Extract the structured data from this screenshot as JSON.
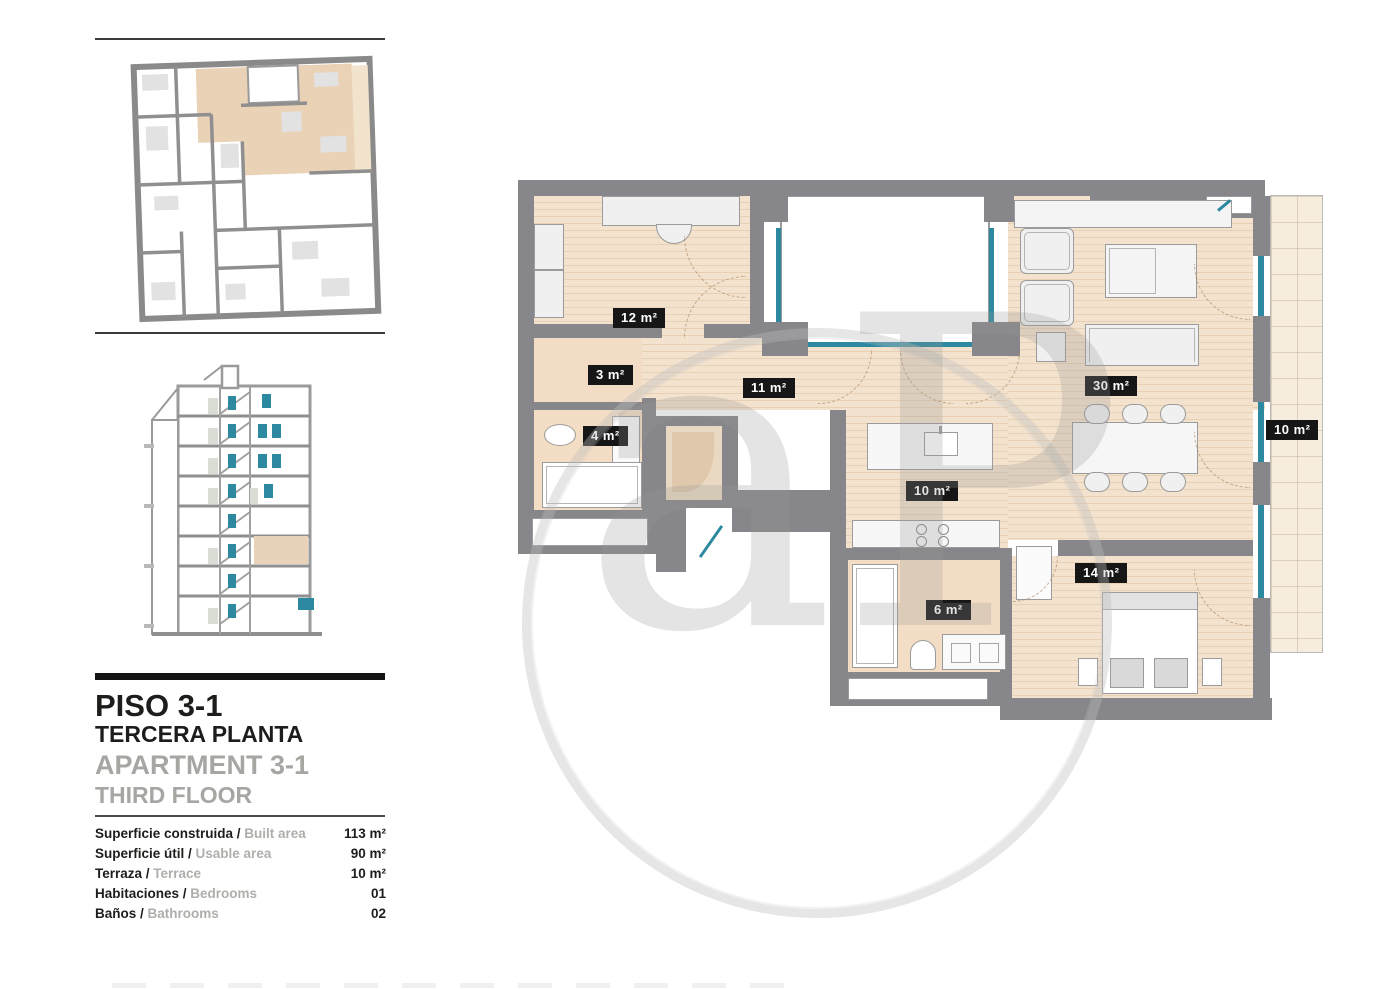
{
  "sidebar": {
    "title_line1": "PISO 3-1",
    "title_line2": "TERCERA PLANTA",
    "subtitle_line1": "APARTMENT 3-1",
    "subtitle_line2": "THIRD FLOOR",
    "separator": " / ",
    "info_rows": [
      {
        "label_es": "Superficie construida",
        "label_en": "Built area",
        "value": "113 m²"
      },
      {
        "label_es": "Superficie útil",
        "label_en": "Usable area",
        "value": "90 m²"
      },
      {
        "label_es": "Terraza",
        "label_en": "Terrace",
        "value": "10 m²"
      },
      {
        "label_es": "Habitaciones",
        "label_en": "Bedrooms",
        "value": "01"
      },
      {
        "label_es": "Baños",
        "label_en": "Bathrooms",
        "value": "02"
      }
    ]
  },
  "floorplan": {
    "room_labels": [
      {
        "name": "bedroom-study",
        "text": "12 m²",
        "x": 95,
        "y": 128
      },
      {
        "name": "hall",
        "text": "3 m²",
        "x": 70,
        "y": 185
      },
      {
        "name": "corridor",
        "text": "11 m²",
        "x": 225,
        "y": 198
      },
      {
        "name": "bathroom-1",
        "text": "4 m²",
        "x": 65,
        "y": 246
      },
      {
        "name": "kitchen",
        "text": "10 m²",
        "x": 388,
        "y": 301
      },
      {
        "name": "living-room",
        "text": "30 m²",
        "x": 567,
        "y": 196
      },
      {
        "name": "terrace",
        "text": "10 m²",
        "x": 748,
        "y": 240
      },
      {
        "name": "bedroom-main",
        "text": "14 m²",
        "x": 557,
        "y": 383
      },
      {
        "name": "bathroom-2",
        "text": "6 m²",
        "x": 408,
        "y": 420
      }
    ]
  },
  "watermark": {
    "letters": "aP"
  },
  "colors": {
    "wall": "#87878b",
    "wood_floor": "#f3e2cd",
    "bath_floor": "#f4ddc5",
    "terrace_floor": "#f7eddf",
    "window_teal": "#2c89a0",
    "label_bg": "#161616",
    "highlight_beige": "#e8d3b8",
    "text_black": "#1d1d1b",
    "text_gray": "#a6a6a3"
  }
}
